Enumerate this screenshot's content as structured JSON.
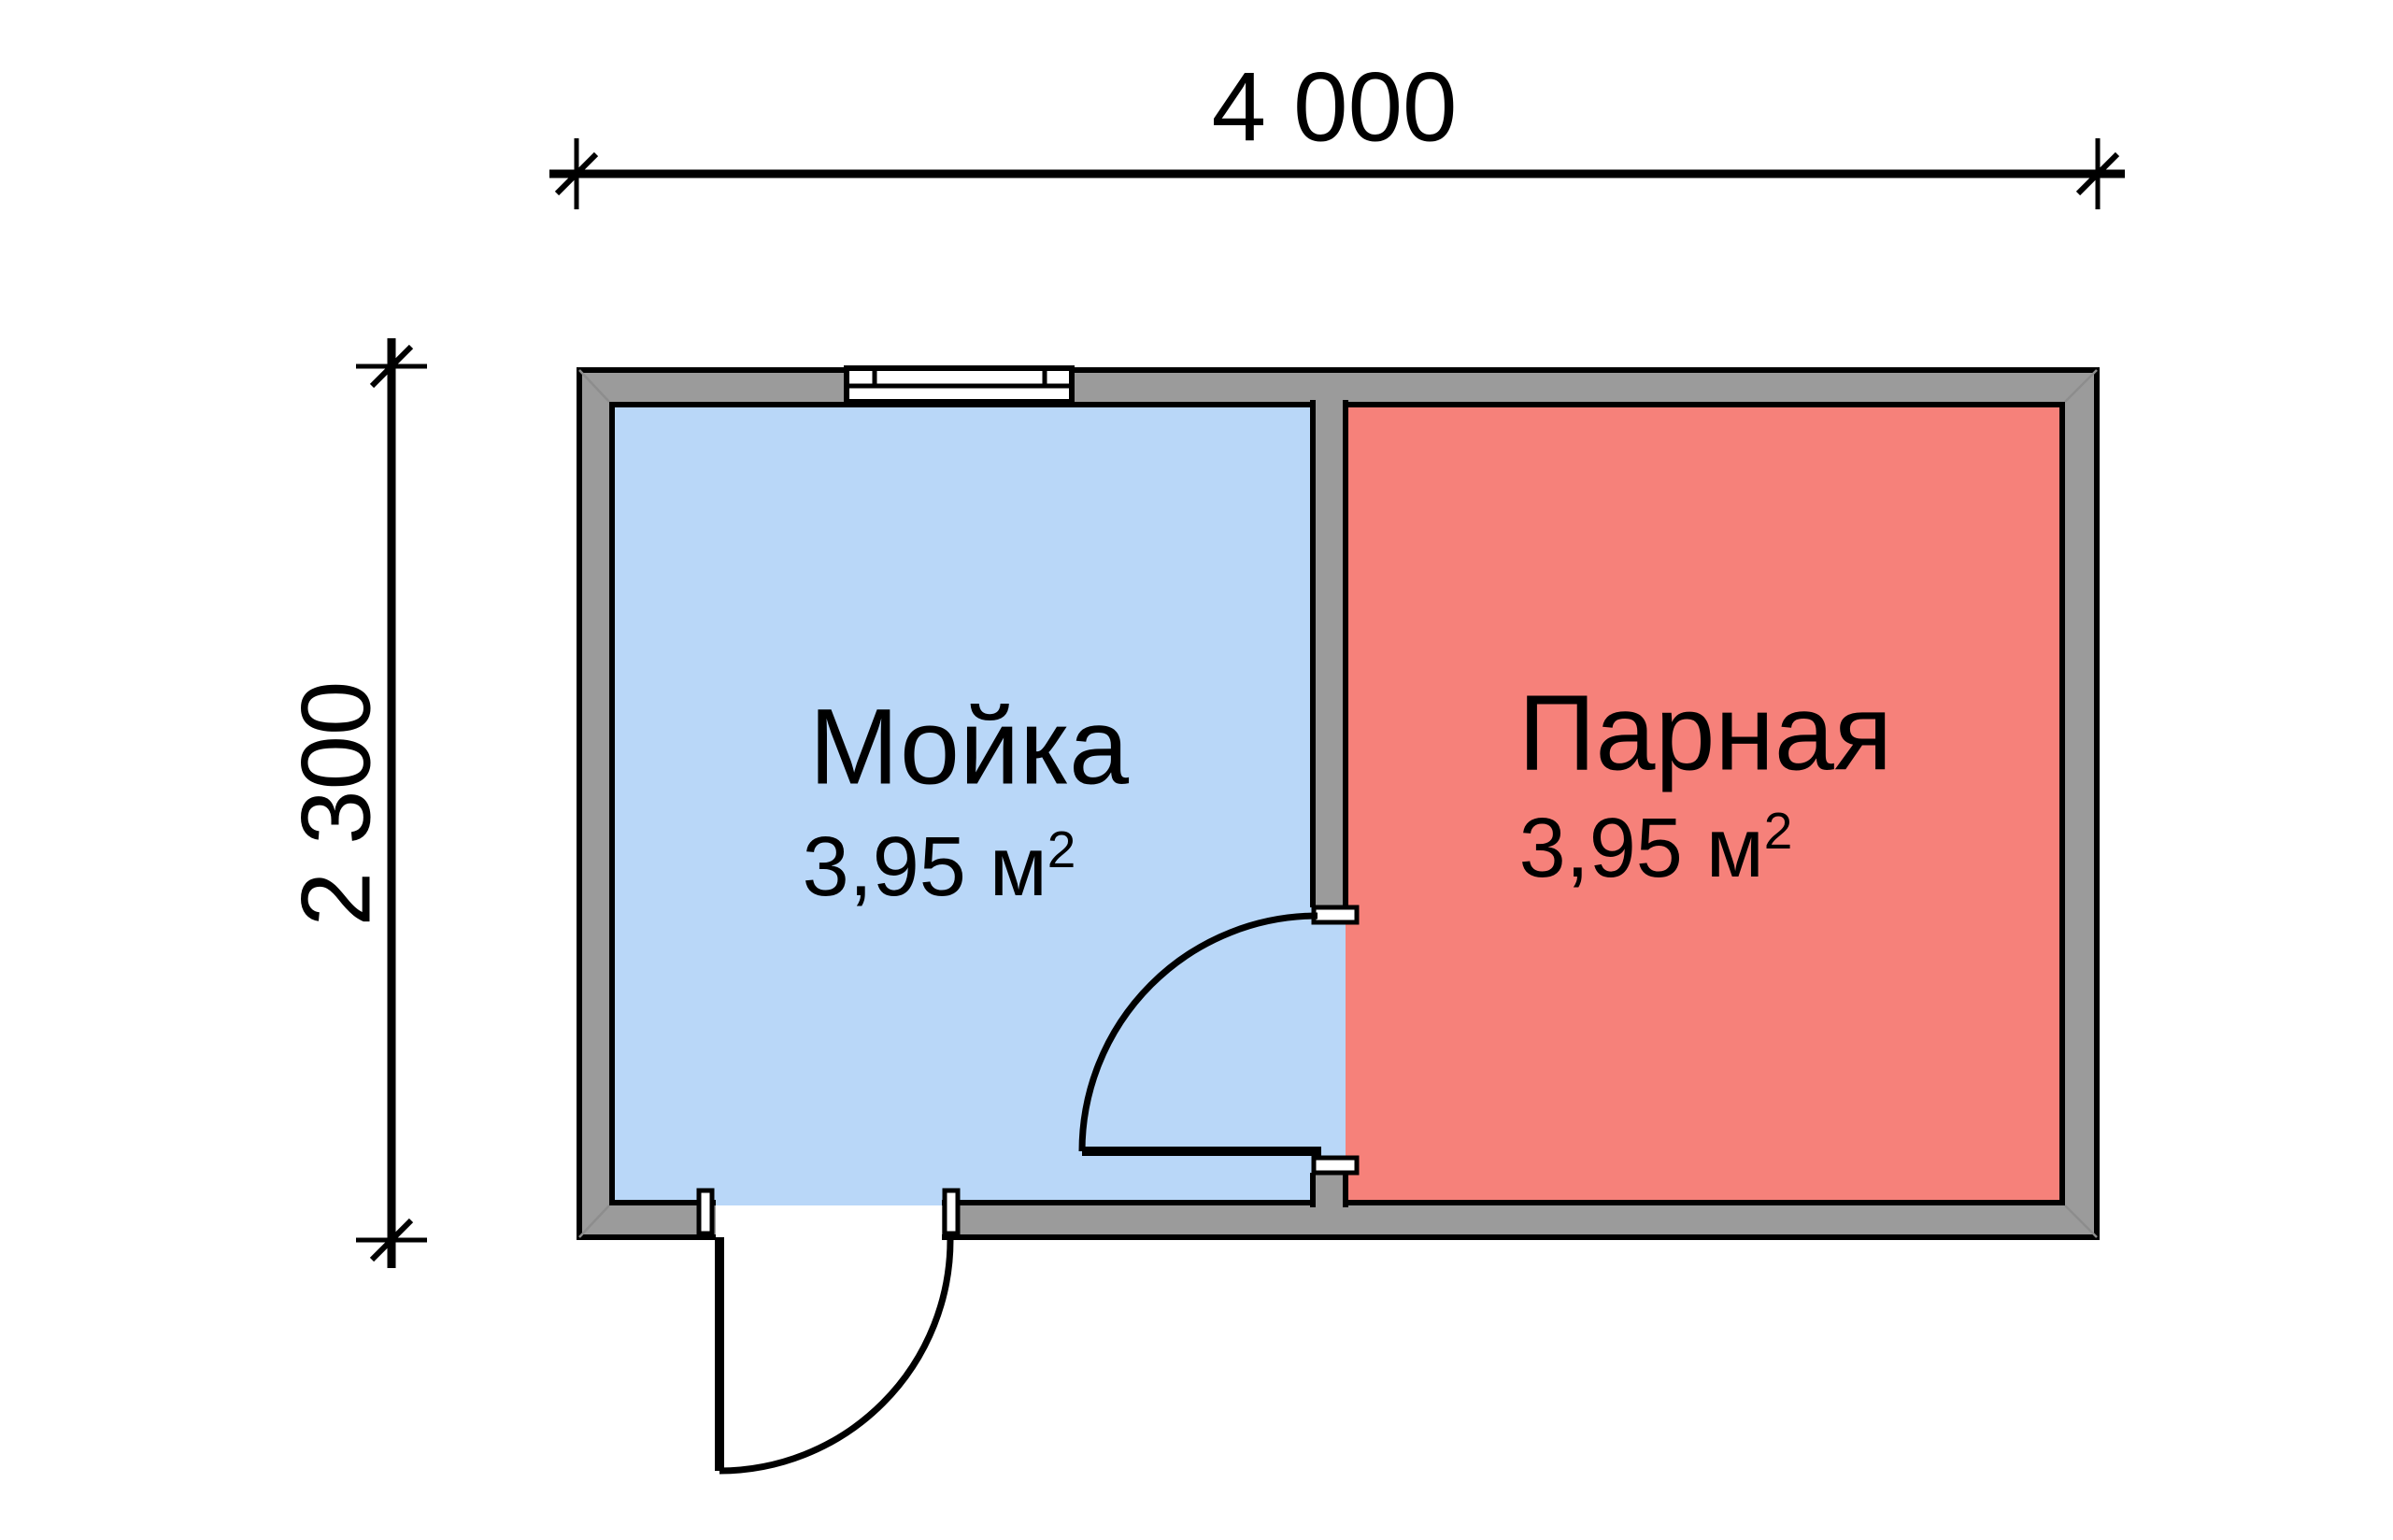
{
  "plan": {
    "dimensions": {
      "width_label": "4 000",
      "height_label": "2 300"
    },
    "rooms": [
      {
        "name": "Мойка",
        "area_value": "3,95 м",
        "area_sup": "2",
        "floor_color": "#b9d7f8"
      },
      {
        "name": "Парная",
        "area_value": "3,95 м",
        "area_sup": "2",
        "floor_color": "#f6817a"
      }
    ],
    "colors": {
      "wall_fill": "#9b9b9b",
      "outline": "#000000"
    }
  }
}
